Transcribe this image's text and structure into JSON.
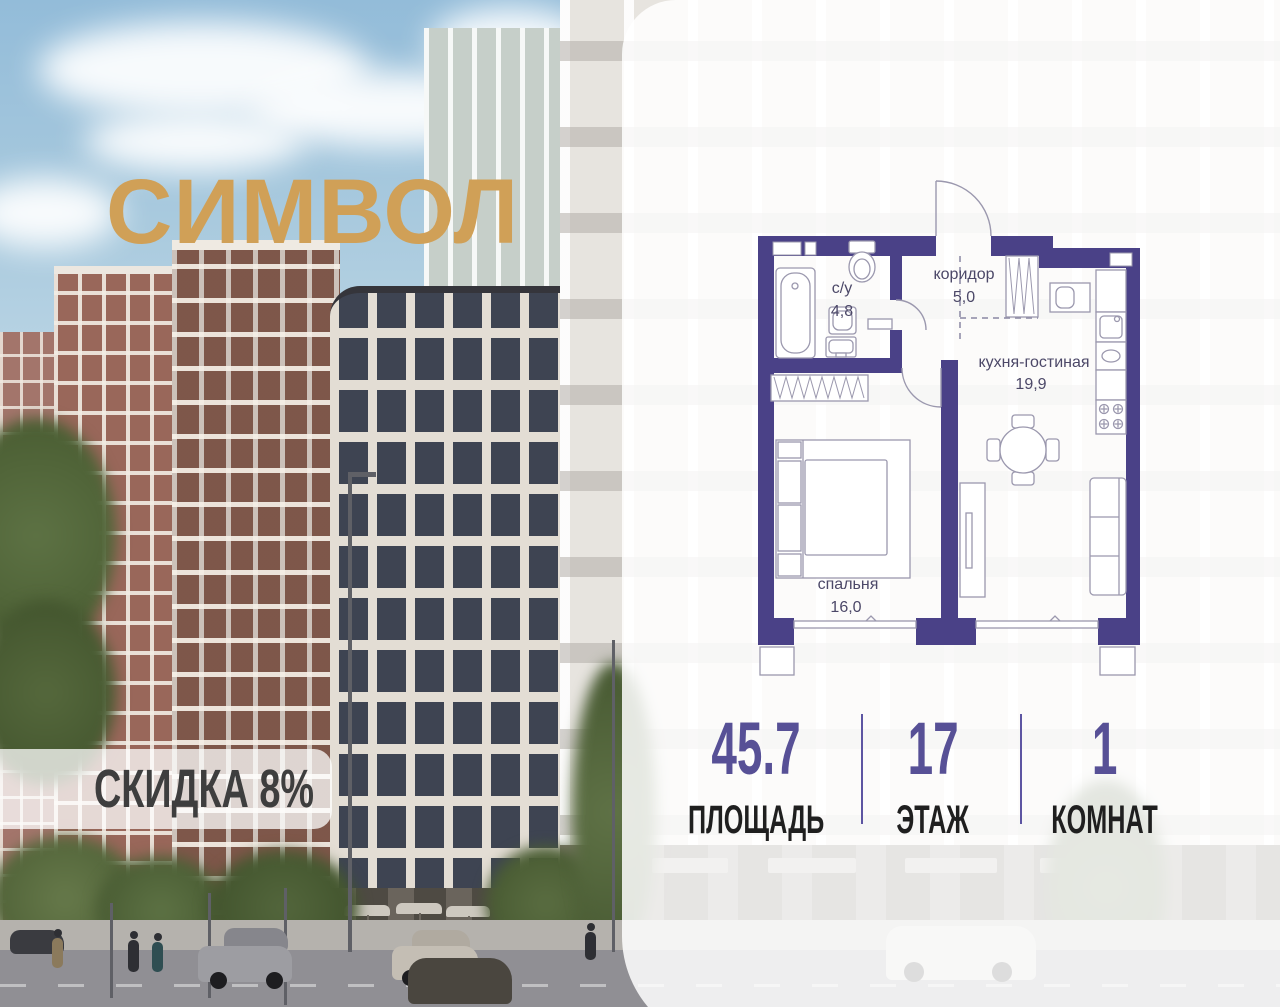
{
  "brand": {
    "title": "СИМВОЛ"
  },
  "discount_badge": {
    "label": "СКИДКА 8%"
  },
  "floor_plan": {
    "rooms": [
      {
        "name": "с/у",
        "area": "4,8"
      },
      {
        "name": "коридор",
        "area": "5,0"
      },
      {
        "name": "кухня-гостиная",
        "area": "19,9"
      },
      {
        "name": "спальня",
        "area": "16,0"
      }
    ]
  },
  "stats": {
    "items": [
      {
        "value": "45.7",
        "label": "ПЛОЩАДЬ"
      },
      {
        "value": "17",
        "label": "ЭТАЖ"
      },
      {
        "value": "1",
        "label": "КОМНАТ"
      }
    ]
  },
  "colors": {
    "brand_gold": "#d0a057",
    "plan_wall": "#4a4187",
    "plan_text": "#4c4868",
    "stat_value": "#575096",
    "stat_label": "#1f1f1f",
    "badge_text": "#3e3e3e"
  }
}
